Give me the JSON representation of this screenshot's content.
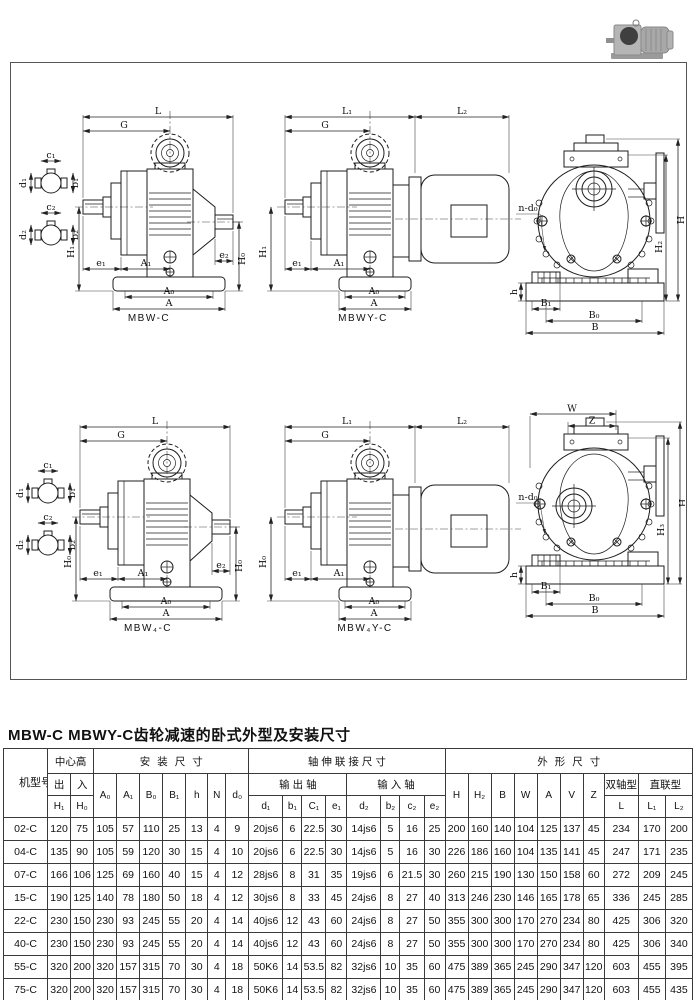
{
  "title": "MBW-C MBWY-C齿轮减速的卧式外型及安装尺寸",
  "drawings": {
    "label1": "MBW-C",
    "label2": "MBWY-C",
    "label4": "MBW₄-C",
    "label5": "MBW₄Y-C"
  },
  "dims": {
    "L": "L",
    "L1": "L₁",
    "L2": "L₂",
    "G": "G",
    "H": "H",
    "H1": "H₁",
    "H0": "H₀",
    "H2": "H₂",
    "H3": "H₃",
    "A": "A",
    "A0": "A₀",
    "A1": "A₁",
    "B": "B",
    "B0": "B₀",
    "B1": "B₁",
    "e1": "e₁",
    "e2": "e₂",
    "h": "h",
    "W": "W",
    "Z": "Z",
    "ndo": "n-d₀",
    "c1": "c₁",
    "b1": "b₁",
    "d1": "d₁",
    "c2": "c₂",
    "b2": "b₂",
    "d2": "d₂"
  },
  "table": {
    "header": {
      "model": "机型号",
      "center_height": "中心高",
      "out": "出",
      "in": "入",
      "h1": "H₁",
      "h0": "H₀",
      "install": "安装尺寸",
      "install_cols": [
        "A₀",
        "A₁",
        "B₀",
        "B₁",
        "h",
        "N",
        "d₀"
      ],
      "shaft": "轴伸联接尺寸",
      "out_shaft": "输出轴",
      "in_shaft": "输入轴",
      "out_cols": [
        "d₁",
        "b₁",
        "C₁",
        "e₁"
      ],
      "in_cols": [
        "d₂",
        "b₂",
        "c₂",
        "e₂"
      ],
      "outline": "外形尺寸",
      "outline_cols": [
        "H",
        "H₂",
        "B",
        "W",
        "A",
        "V",
        "Z"
      ],
      "dual": "双轴型",
      "direct": "直联型",
      "L": "L",
      "L1": "L₁",
      "L2": "L₂"
    },
    "rows": [
      {
        "model": "02-C",
        "values": [
          "120",
          "75",
          "105",
          "57",
          "110",
          "25",
          "13",
          "4",
          "9",
          "20js6",
          "6",
          "22.5",
          "30",
          "14js6",
          "5",
          "16",
          "25",
          "200",
          "160",
          "140",
          "104",
          "125",
          "137",
          "45",
          "234",
          "170",
          "200"
        ]
      },
      {
        "model": "04-C",
        "values": [
          "135",
          "90",
          "105",
          "59",
          "120",
          "30",
          "15",
          "4",
          "10",
          "20js6",
          "6",
          "22.5",
          "30",
          "14js6",
          "5",
          "16",
          "30",
          "226",
          "186",
          "160",
          "104",
          "135",
          "141",
          "45",
          "247",
          "171",
          "235"
        ]
      },
      {
        "model": "07-C",
        "values": [
          "166",
          "106",
          "125",
          "69",
          "160",
          "40",
          "15",
          "4",
          "12",
          "28js6",
          "8",
          "31",
          "35",
          "19js6",
          "6",
          "21.5",
          "30",
          "260",
          "215",
          "190",
          "130",
          "150",
          "158",
          "60",
          "272",
          "209",
          "245"
        ]
      },
      {
        "model": "15-C",
        "values": [
          "190",
          "125",
          "140",
          "78",
          "180",
          "50",
          "18",
          "4",
          "12",
          "30js6",
          "8",
          "33",
          "45",
          "24js6",
          "8",
          "27",
          "40",
          "313",
          "246",
          "230",
          "146",
          "165",
          "178",
          "65",
          "336",
          "245",
          "285"
        ]
      },
      {
        "model": "22-C",
        "values": [
          "230",
          "150",
          "230",
          "93",
          "245",
          "55",
          "20",
          "4",
          "14",
          "40js6",
          "12",
          "43",
          "60",
          "24js6",
          "8",
          "27",
          "50",
          "355",
          "300",
          "300",
          "170",
          "270",
          "234",
          "80",
          "425",
          "306",
          "320"
        ]
      },
      {
        "model": "40-C",
        "values": [
          "230",
          "150",
          "230",
          "93",
          "245",
          "55",
          "20",
          "4",
          "14",
          "40js6",
          "12",
          "43",
          "60",
          "24js6",
          "8",
          "27",
          "50",
          "355",
          "300",
          "300",
          "170",
          "270",
          "234",
          "80",
          "425",
          "306",
          "340"
        ]
      },
      {
        "model": "55-C",
        "values": [
          "320",
          "200",
          "320",
          "157",
          "315",
          "70",
          "30",
          "4",
          "18",
          "50K6",
          "14",
          "53.5",
          "82",
          "32js6",
          "10",
          "35",
          "60",
          "475",
          "389",
          "365",
          "245",
          "290",
          "347",
          "120",
          "603",
          "455",
          "395"
        ]
      },
      {
        "model": "75-C",
        "values": [
          "320",
          "200",
          "320",
          "157",
          "315",
          "70",
          "30",
          "4",
          "18",
          "50K6",
          "14",
          "53.5",
          "82",
          "32js6",
          "10",
          "35",
          "60",
          "475",
          "389",
          "365",
          "245",
          "290",
          "347",
          "120",
          "603",
          "455",
          "435"
        ]
      }
    ]
  }
}
